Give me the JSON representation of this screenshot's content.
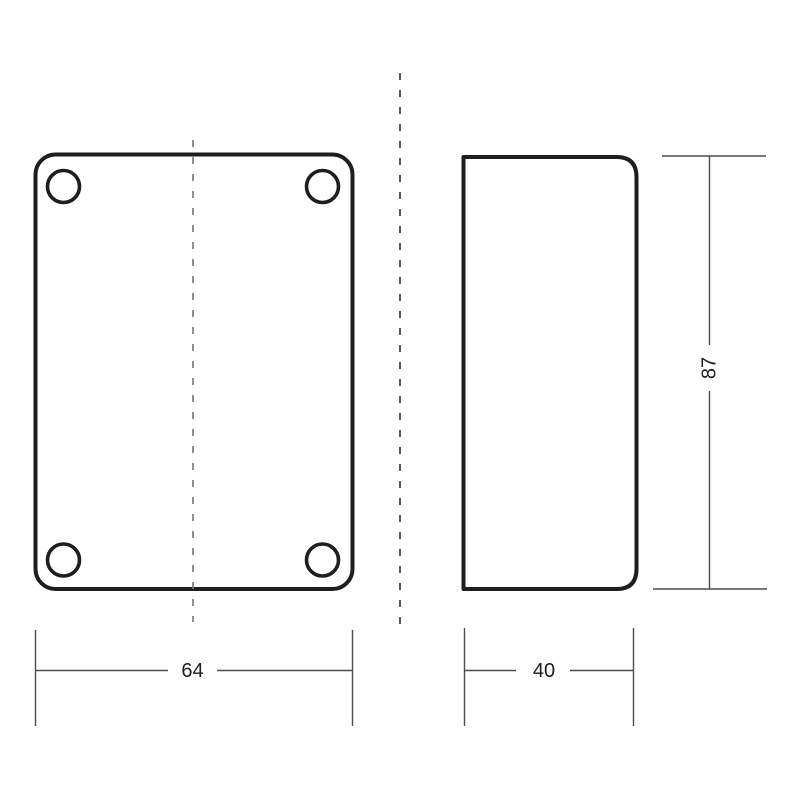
{
  "drawing": {
    "title": "two-view-technical-drawing",
    "dimensions": {
      "front_width": "64",
      "side_width": "40",
      "height": "87"
    },
    "colors": {
      "background": "#ffffff",
      "object_line": "#1e1e1e",
      "dimension_line": "#4c4c4c",
      "centerline": "#7b7b7b",
      "separator_line": "#3a3a3a",
      "text": "#1e1e1e"
    }
  }
}
